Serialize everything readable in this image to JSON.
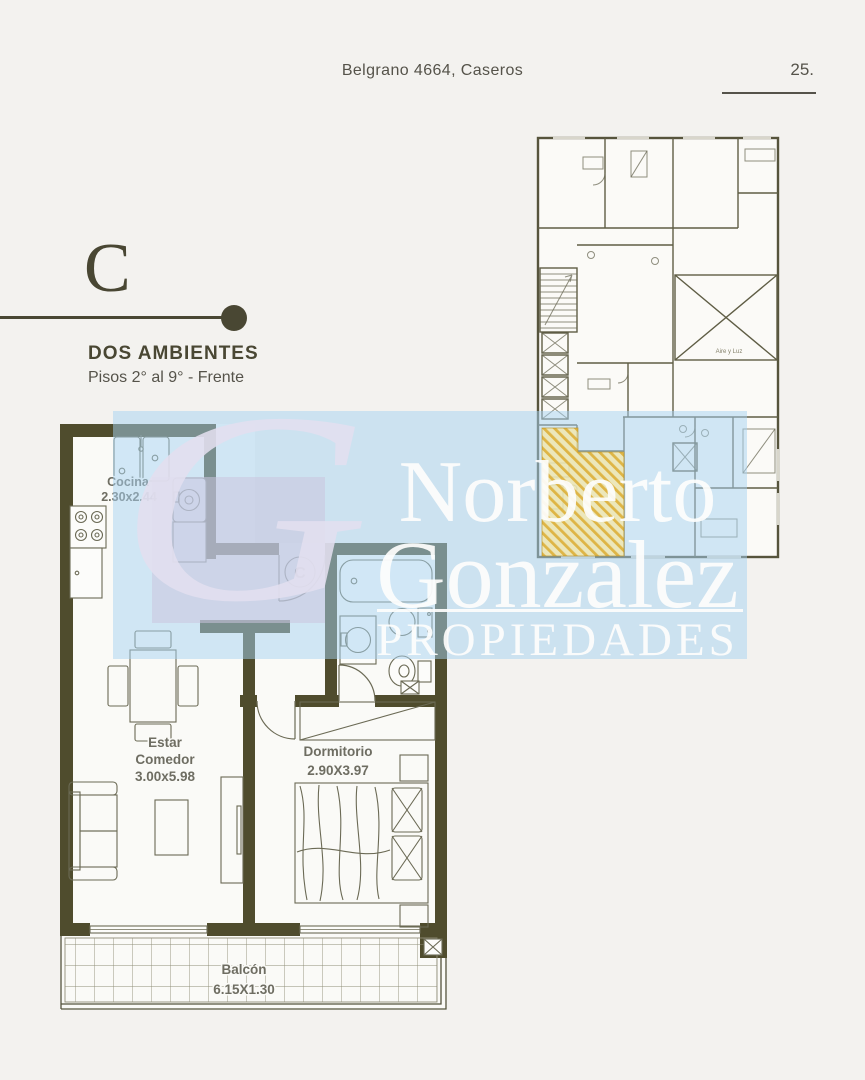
{
  "theme": {
    "bg": "#f3f2ef",
    "ink": "#55534a",
    "accent": "#494733",
    "wall": "#4f4c2d",
    "label": "#6e6d62",
    "band": "rgba(165,210,242,0.5)",
    "lavender": "rgba(203,197,222,0.55)",
    "monogram": "rgba(226,223,239,0.88)",
    "wm-text": "rgba(253,253,252,0.93)",
    "hl-fill": "rgba(247,231,165,0.72)",
    "hl-line": "rgba(219,172,48,0.85)"
  },
  "header": {
    "address": "Belgrano 4664, Caseros",
    "page_number": "25."
  },
  "unit": {
    "letter": "C",
    "type_label": "DOS AMBIENTES",
    "floors_label": "Pisos 2° al 9° - Frente"
  },
  "watermark": {
    "monogram": "G",
    "name_line1": "Norberto",
    "name_line2": "Gonzalez",
    "tagline": "PROPIEDADES"
  },
  "floor_plan": {
    "entrance_marker": "C",
    "rooms": {
      "cocina": {
        "name": "Cocina",
        "dims": "2.30x2.44"
      },
      "estar": {
        "name_line1": "Estar",
        "name_line2": "Comedor",
        "dims": "3.00x5.98"
      },
      "dormitorio": {
        "name": "Dormitorio",
        "dims": "2.90X3.97"
      },
      "balcon": {
        "name": "Balcón",
        "dims": "6.15X1.30"
      }
    }
  },
  "key_plan": {
    "highlighted_unit": "C",
    "light_well_label": "Aire y Luz"
  }
}
